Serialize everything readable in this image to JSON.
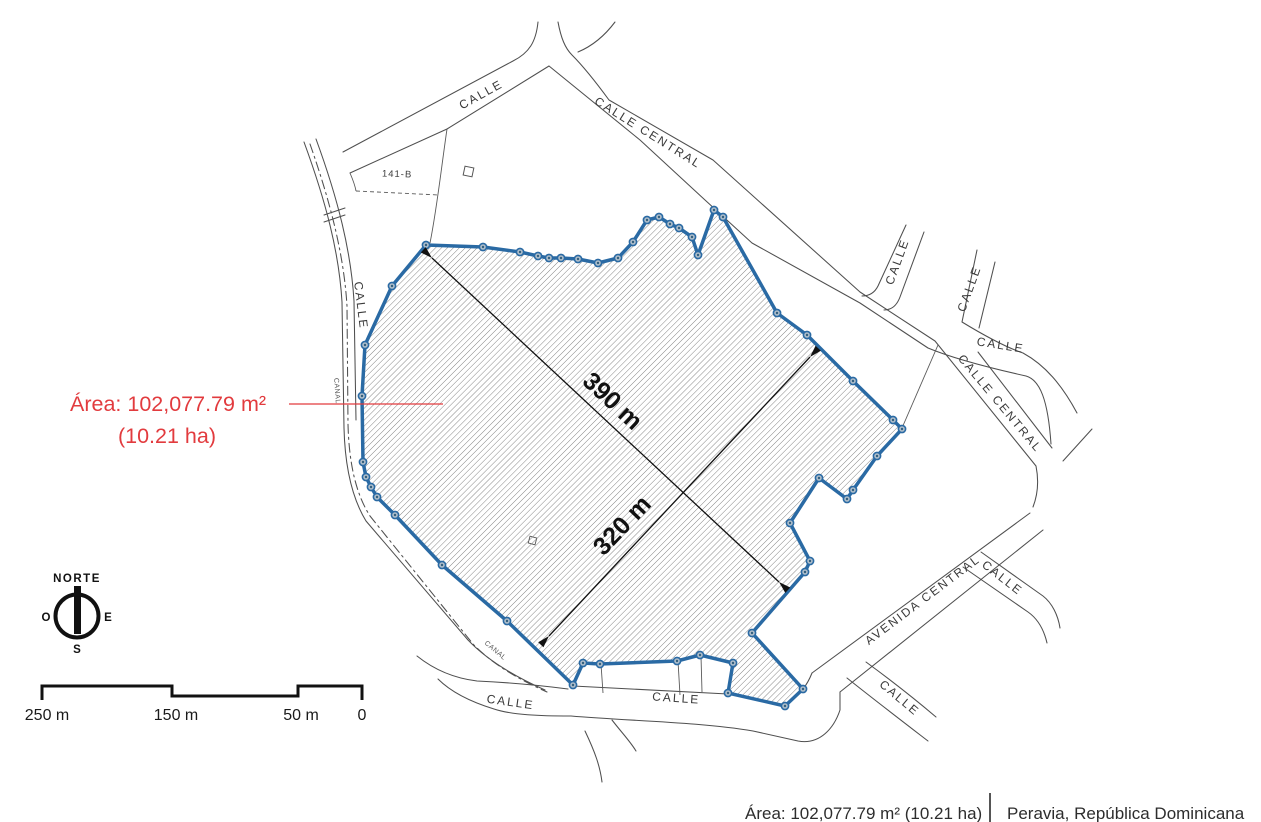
{
  "map": {
    "area_callout": {
      "line1": "Área: 102,077.79 m²",
      "line2": "(10.21 ha)"
    },
    "dimensions": [
      {
        "label": "390 m"
      },
      {
        "label": "320 m"
      }
    ],
    "parcel_code": "141-B",
    "streets": [
      {
        "id": "calle-top-left",
        "text": "CALLE"
      },
      {
        "id": "calle-central-top",
        "text": "CALLE CENTRAL"
      },
      {
        "id": "calle-northeast-1",
        "text": "CALLE"
      },
      {
        "id": "calle-northeast-2",
        "text": "CALLE"
      },
      {
        "id": "calle-east",
        "text": "CALLE"
      },
      {
        "id": "calle-central-east",
        "text": "CALLE CENTRAL"
      },
      {
        "id": "avenida-central",
        "text": "AVENIDA CENTRAL"
      },
      {
        "id": "calle-southeast-upper",
        "text": "CALLE"
      },
      {
        "id": "calle-southeast-lower",
        "text": "CALLE"
      },
      {
        "id": "calle-bottom-left",
        "text": "CALLE"
      },
      {
        "id": "calle-bottom-center",
        "text": "CALLE"
      },
      {
        "id": "calle-west",
        "text": "CALLE"
      },
      {
        "id": "canal-west",
        "text": "CANAL"
      },
      {
        "id": "canal-south",
        "text": "CANAL"
      }
    ],
    "compass": {
      "north": "NORTE",
      "west": "O",
      "east": "E",
      "south": "S"
    },
    "scale_bar": {
      "labels": [
        "250 m",
        "150 m",
        "50 m",
        "0"
      ]
    }
  },
  "footer": {
    "area_text": "Área: 102,077.79 m²  (10.21 ha)",
    "location_text": "Peravia, República Dominicana"
  },
  "colors": {
    "parcel_outline": "#2a6aa4",
    "area_callout_red": "#e23b3e",
    "road_line": "#4f4f4f",
    "hatch_line": "#6a6a6a",
    "dimension_text": "#111111"
  }
}
